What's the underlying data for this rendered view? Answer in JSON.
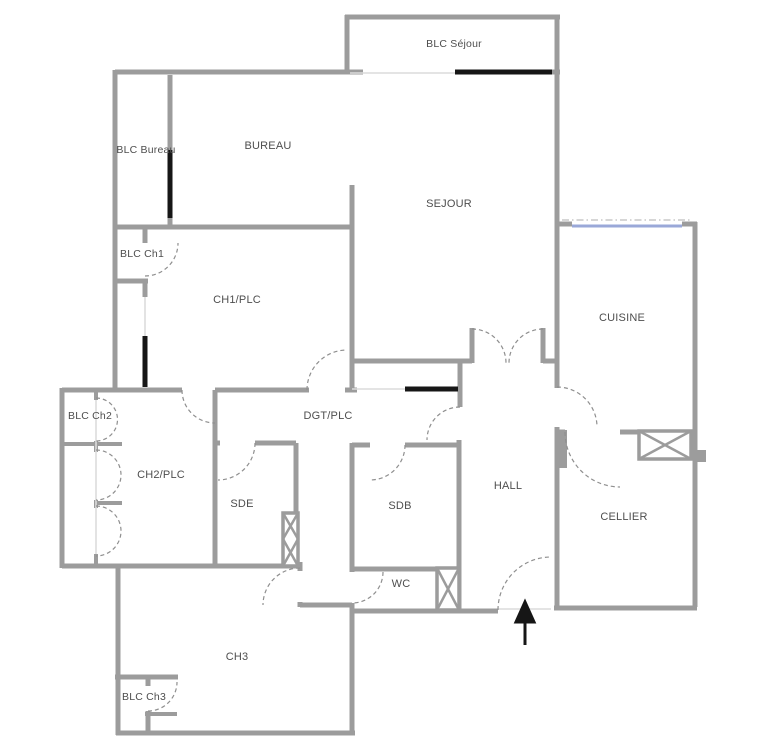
{
  "title": "Apartment floor plan",
  "rooms": [
    {
      "id": "blc-sejour",
      "label": "BLC Séjour"
    },
    {
      "id": "blc-bureau",
      "label": "BLC Bureau"
    },
    {
      "id": "bureau",
      "label": "BUREAU"
    },
    {
      "id": "sejour",
      "label": "SEJOUR"
    },
    {
      "id": "blc-ch1",
      "label": "BLC Ch1"
    },
    {
      "id": "ch1-plc",
      "label": "CH1/PLC"
    },
    {
      "id": "cuisine",
      "label": "CUISINE"
    },
    {
      "id": "blc-ch2",
      "label": "BLC Ch2"
    },
    {
      "id": "dgt-plc",
      "label": "DGT/PLC"
    },
    {
      "id": "ch2-plc",
      "label": "CH2/PLC"
    },
    {
      "id": "sde",
      "label": "SDE"
    },
    {
      "id": "sdb",
      "label": "SDB"
    },
    {
      "id": "hall",
      "label": "HALL"
    },
    {
      "id": "cellier",
      "label": "CELLIER"
    },
    {
      "id": "wc",
      "label": "WC"
    },
    {
      "id": "ch3",
      "label": "CH3"
    },
    {
      "id": "blc-ch3",
      "label": "BLC Ch3"
    }
  ],
  "colors": {
    "wall": "#9c9c9c",
    "glazing_black": "#161616",
    "glazing_blue": "#9aa8d8",
    "door_arc": "#8f8f8f",
    "label_text": "#4e4e4e",
    "background": "#ffffff"
  },
  "symbols": {
    "entrance_arrow": "upward arrow marking main entrance",
    "duct_shaft": "crossed-box technical shaft",
    "door_swing": "dashed quarter-circle door swing",
    "window": "solid glazing bar on wall"
  }
}
